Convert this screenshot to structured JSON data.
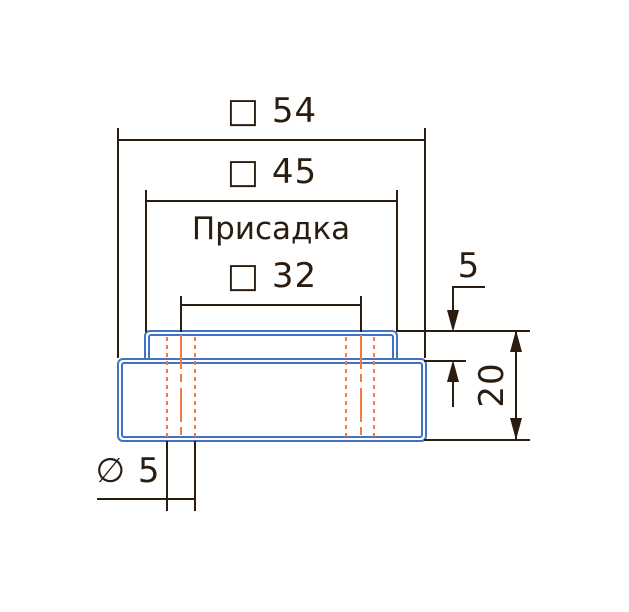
{
  "drawing": {
    "note": "Присадка",
    "dimensions": {
      "outer_width": {
        "label": "□ 54",
        "symbol": "square",
        "value": 54
      },
      "step_width": {
        "label": "□ 45",
        "symbol": "square",
        "value": 45
      },
      "hole_spacing": {
        "label": "□ 32",
        "symbol": "square",
        "value": 32
      },
      "step_height": {
        "label": "5",
        "value": 5
      },
      "total_height": {
        "label": "20",
        "value": 20
      },
      "hole_diameter": {
        "label": "∅ 5",
        "symbol": "diameter",
        "value": 5
      }
    }
  },
  "colors": {
    "line": "#2b1c10",
    "part_outline": "#4472c4",
    "hole_lines": "#f07b42",
    "background": "#ffffff"
  }
}
